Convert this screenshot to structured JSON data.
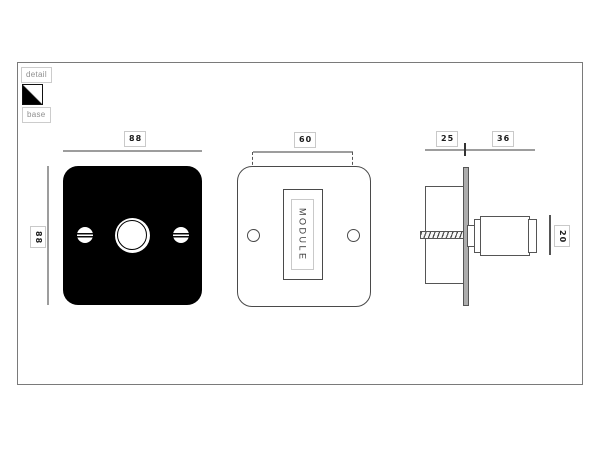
{
  "legend": {
    "detail_label": "detail",
    "base_label": "base"
  },
  "base_front_view": {
    "top_dim": "88",
    "left_dim": "88"
  },
  "module_front_view": {
    "top_dim": "60",
    "module_label": "MODULE"
  },
  "side_view": {
    "back_depth_dim": "25",
    "front_depth_dim": "36",
    "knob_height_dim": "20"
  },
  "colors": {
    "detail_finish": "#ffffff",
    "base_plate": "#000000",
    "dim_line_gray": "#9d9d9d",
    "outline_gray": "#555555"
  }
}
